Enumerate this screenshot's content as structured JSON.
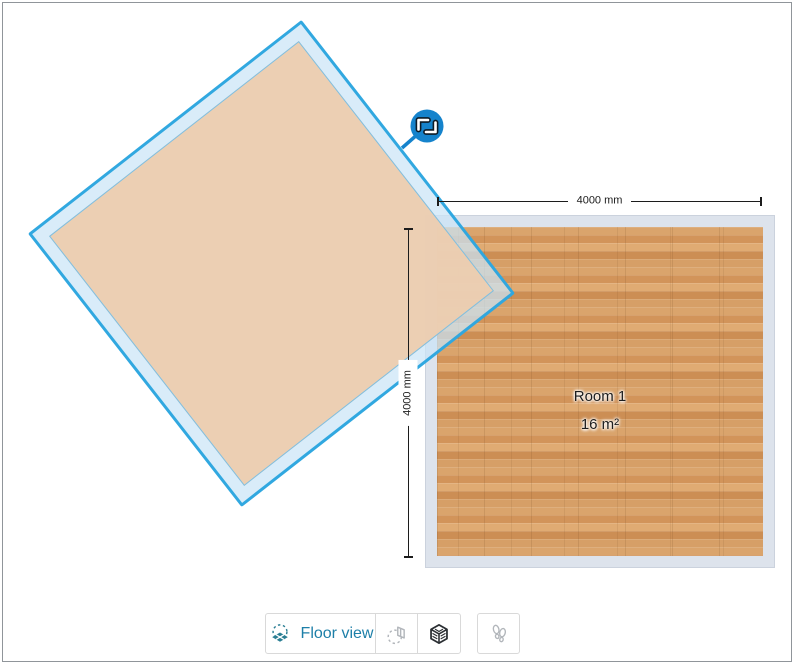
{
  "colors": {
    "selection_blue": "#29a4df",
    "handle_blue": "#1583cc",
    "room2_wall_tint": "#cde7f7",
    "room2_floor": "#eccdae",
    "room1_wall": "#dde3ec",
    "wood_base": "#d59e66",
    "dim_line": "#1c1c1c",
    "active_teal": "#1d7fa8",
    "icon_teal": "#2a7e93",
    "icon_gray": "#b2b6bb",
    "icon_dark": "#2b2f33",
    "button_border": "#d9d9d9",
    "frame_border": "#90959a"
  },
  "rooms": {
    "room1": {
      "name": "Room 1",
      "area": "16 m²"
    },
    "room2": {
      "selected": true,
      "rotate_handle_icon": "rotate-icon"
    }
  },
  "dimensions": {
    "width_label": "4000 mm",
    "height_label": "4000 mm"
  },
  "toolbar": {
    "floor_view": {
      "label": "Floor view",
      "icon": "floor-view-icon"
    },
    "wall_view": {
      "icon": "wall-view-icon"
    },
    "cube_view": {
      "icon": "3d-cube-icon"
    },
    "walk_view": {
      "icon": "footprints-icon"
    }
  }
}
